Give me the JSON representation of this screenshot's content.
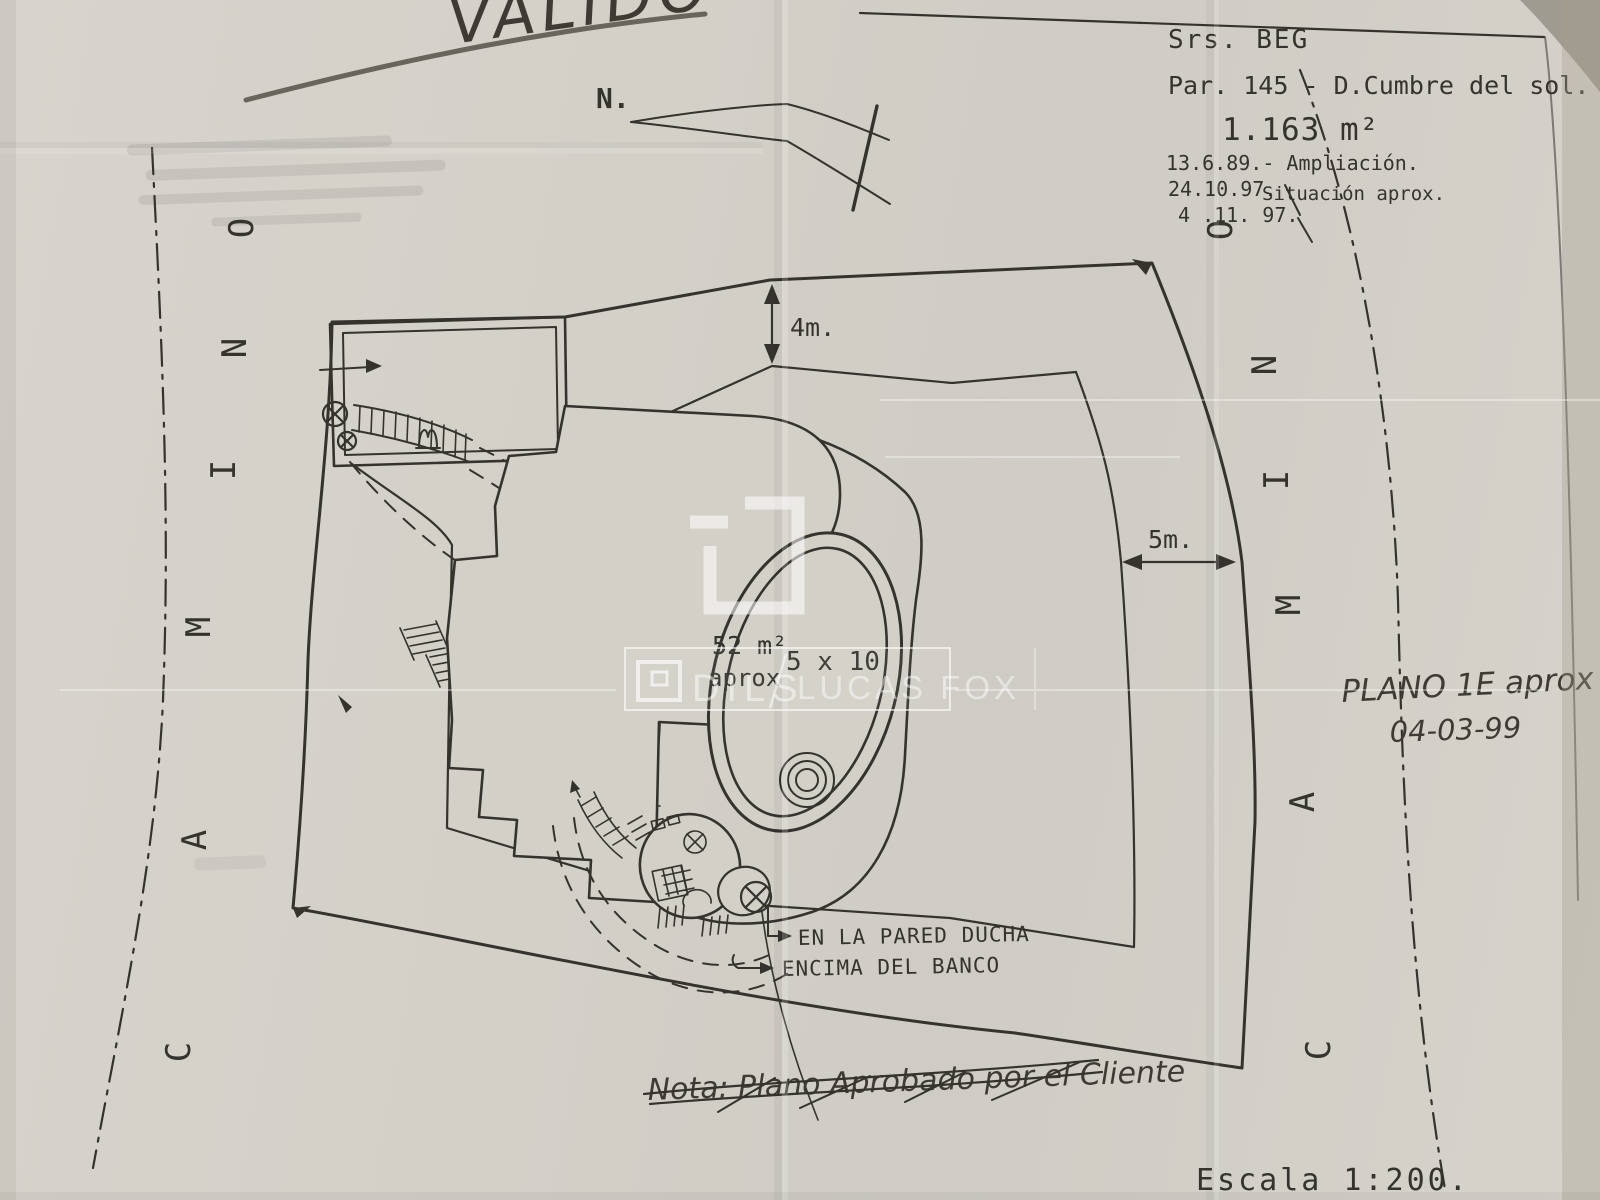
{
  "stamp": {
    "text": "VALIDO"
  },
  "north": {
    "label": "N."
  },
  "title_block": {
    "client": "Srs. BEG",
    "parcel": "Par. 145 - D.Cumbre del sol.",
    "area": "1.163 m²",
    "rev_1": "13.6.89.- Ampliación.",
    "rev_2_date": "24.10.97.",
    "rev_2_note": "Situación aprox.",
    "rev_3_date": "4 .11. 97."
  },
  "roads": {
    "name": "CAMINO",
    "left_letters_top_to_bottom": [
      "O",
      "N",
      "I",
      "M",
      "A",
      "C"
    ],
    "right_letters_top_to_bottom": [
      "O",
      "N",
      "I",
      "M",
      "A",
      "C"
    ]
  },
  "dimensions": {
    "street_setback": "4m.",
    "side_setback": "5m."
  },
  "plan_labels": {
    "terrace_area": "52 m²",
    "terrace_area_qualifier": "aprox",
    "pool_size": "5 x 10",
    "shower_note_line1": "EN LA PARED DUCHA",
    "shower_note_line2": "ENCIMA DEL BANCO"
  },
  "handwritten": {
    "plan_ref": "PLANO 1E aprox",
    "plan_date": "04-03-99",
    "crossed_out_note": "Nota: Plano Aprobado por el Cliente",
    "scale": "Escala 1:200."
  },
  "watermark": {
    "brand_left": "DILS",
    "divider": "/",
    "brand_right": "LUCAS FOX"
  },
  "colors": {
    "paper": "#d3d0c8",
    "ink": "#35332e",
    "handwriting": "#3d3b33",
    "watermark": "#ffffff"
  }
}
